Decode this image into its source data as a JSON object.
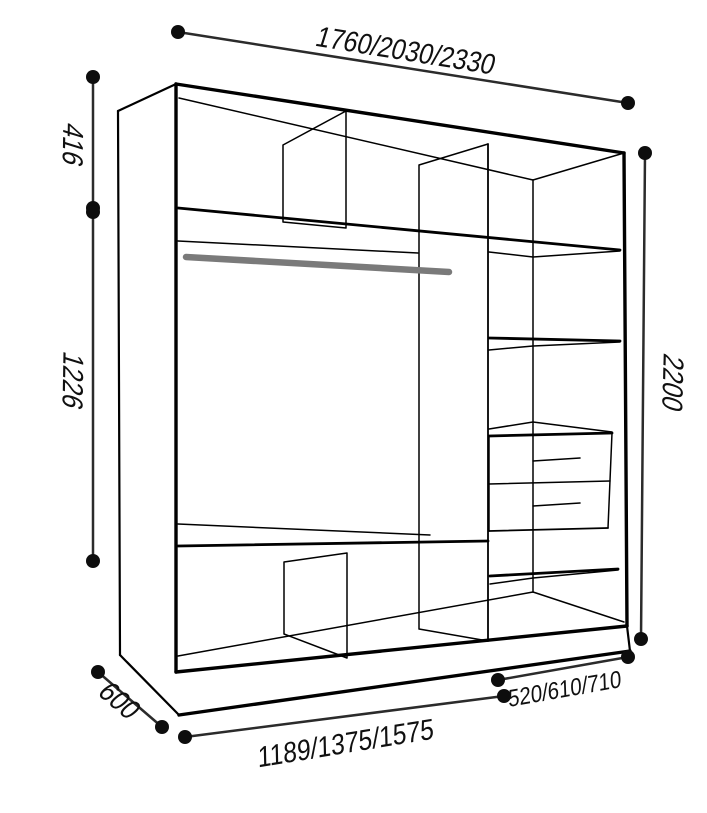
{
  "figure": {
    "title": "Wardrobe interior dimension diagram",
    "dimensions": {
      "width_total": "1760/2030/2330",
      "top_section_height": "416",
      "middle_section_height": "1226",
      "total_height": "2200",
      "depth": "600",
      "left_section_width": "1189/1375/1575",
      "right_section_width": "520/610/710"
    },
    "colors": {
      "outline": "#000000",
      "dimension_line": "#2b2b2b",
      "dot": "#0d0d0d",
      "hanger_rod": "#7a7a7a",
      "background": "#ffffff"
    }
  }
}
